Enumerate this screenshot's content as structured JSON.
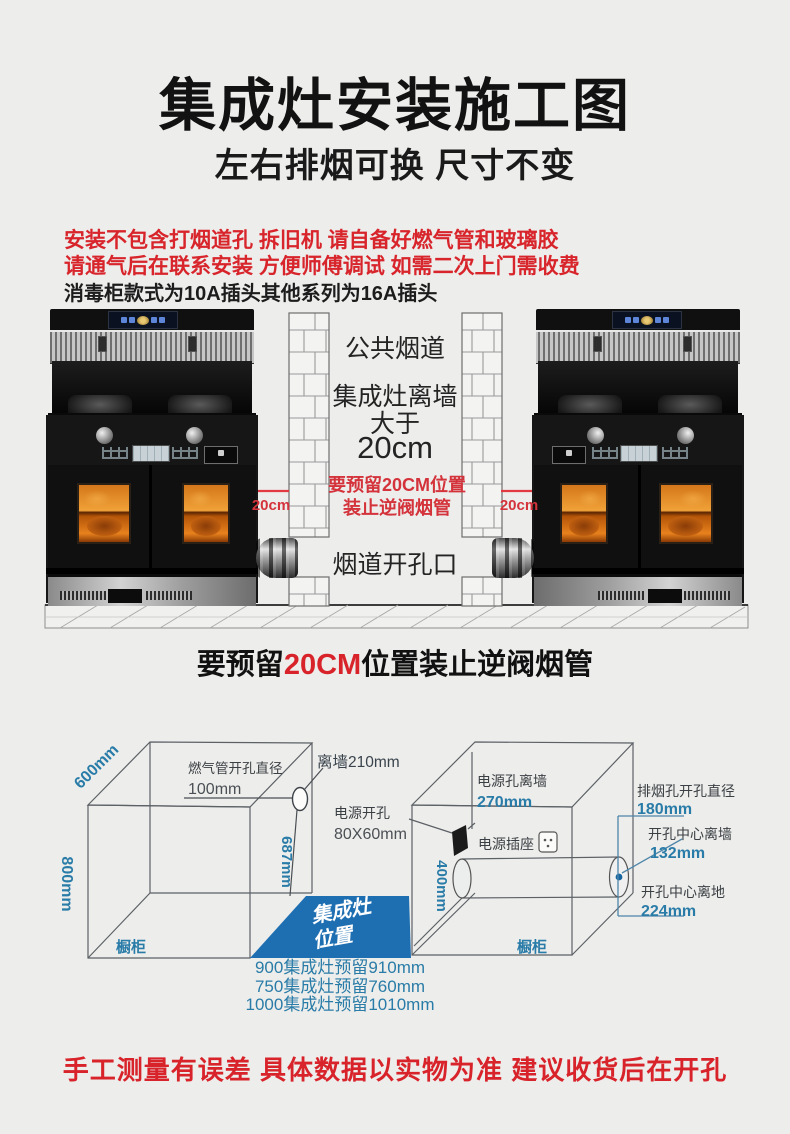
{
  "header": {
    "title": "集成灶安装施工图",
    "subtitle": "左右排烟可换 尺寸不变",
    "warning_line1": "安装不包含打烟道孔 拆旧机 请自备好燃气管和玻璃胶",
    "warning_line2": "请通气后在联系安装 方便师傅调试 如需二次上门需收费",
    "note_line": "消毒柜款式为10A插头其他系列为16A插头"
  },
  "installation_diagram": {
    "flue_label": "公共烟道",
    "clearance_line1": "集成灶离墙",
    "clearance_line2": "大于",
    "clearance_line3": "20cm",
    "reserve_note_line1": "要预留20CM位置",
    "reserve_note_line2": "装止逆阀烟管",
    "opening_label": "烟道开孔口",
    "left_gap_label": "20cm",
    "right_gap_label": "20cm"
  },
  "reserve_banner": {
    "prefix": "要预留",
    "highlight": "20CM",
    "suffix": "位置装止逆阀烟管"
  },
  "dimension_diagram": {
    "left_cabinet": {
      "depth": "600mm",
      "height": "800mm",
      "gas_hole_label": "燃气管开孔直径",
      "gas_hole_value": "100mm",
      "gas_wall_label": "离墙210mm",
      "gas_height": "687mm",
      "power_hole_label": "电源开孔",
      "power_hole_value": "80X60mm",
      "cabinet_label": "橱柜",
      "stove_area_line1": "集成灶",
      "stove_area_line2": "位置"
    },
    "right_cabinet": {
      "power_wall_label": "电源孔离墙",
      "power_wall_value": "270mm",
      "socket_label": "电源插座",
      "height_400": "400mm",
      "vent_dia_label": "排烟孔开孔直径",
      "vent_dia_value": "180mm",
      "vent_center_wall_label": "开孔中心离墙",
      "vent_center_wall_value": "132mm",
      "vent_center_floor_label": "开孔中心离地",
      "vent_center_floor_value": "224mm",
      "cabinet_label": "橱柜"
    },
    "reserve_table": [
      "900集成灶预留910mm",
      "750集成灶预留760mm",
      "1000集成灶预留1010mm"
    ]
  },
  "footer": {
    "warning": "手工测量有误差 具体数据以实物为准 建议收货后在开孔"
  },
  "colors": {
    "accent_red": "#d8232a",
    "dimension_teal": "#2a7ca8",
    "stove_area_blue": "#1e6fb2"
  }
}
